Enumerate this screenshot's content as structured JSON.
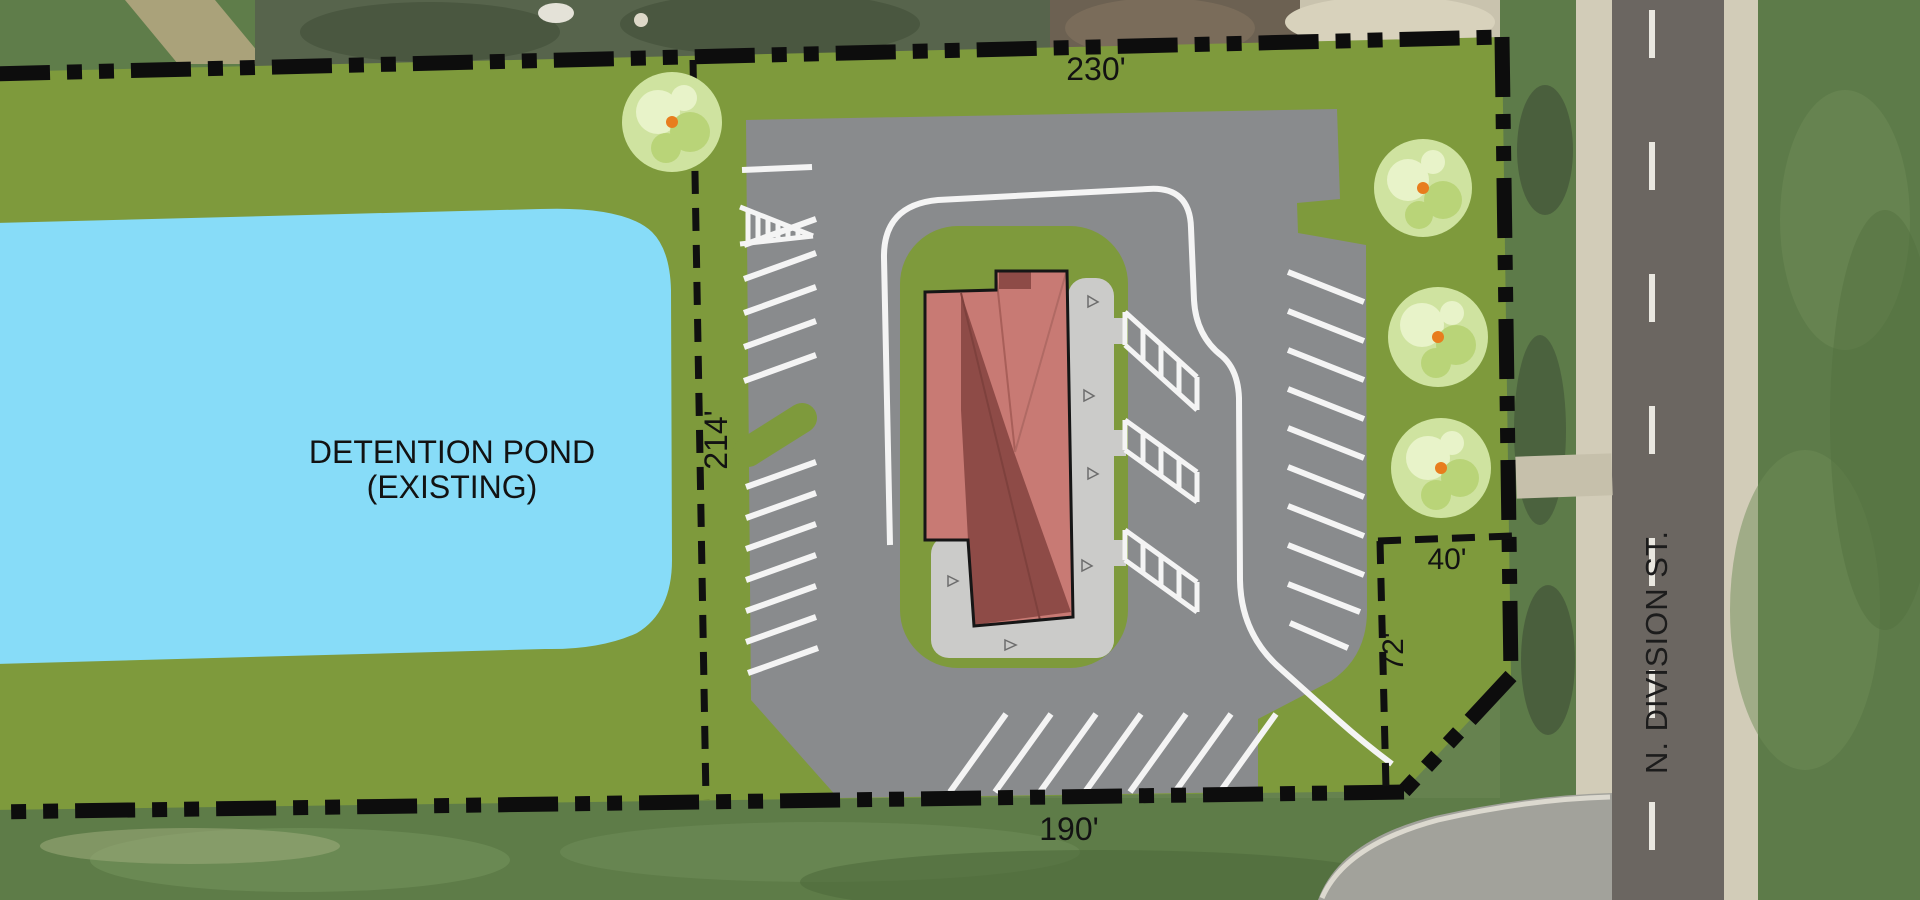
{
  "plan": {
    "type": "architectural-site-plan",
    "labels": {
      "north_dim": "230'",
      "west_dim": "214'",
      "south_dim": "190'",
      "outlot_width": "40'",
      "outlot_depth": "72'",
      "pond_name": "DETENTION POND",
      "pond_status": "(EXISTING)",
      "street_name": "N. DIVISION ST."
    },
    "colors": {
      "site_green": "#7e9a3c",
      "pond_blue": "#87dcf8",
      "pavement_gray": "#898b8d",
      "sidewalk_gray": "#cbcbc9",
      "roof_light": "#c87a74",
      "roof_dark": "#8e4b47",
      "stripe_white": "#f4f4f4",
      "boundary_black": "#0d0d0d",
      "tree_light": "#cfe3a0",
      "tree_accent": "#b9d478",
      "tree_dot_orange": "#e87d1e"
    }
  }
}
